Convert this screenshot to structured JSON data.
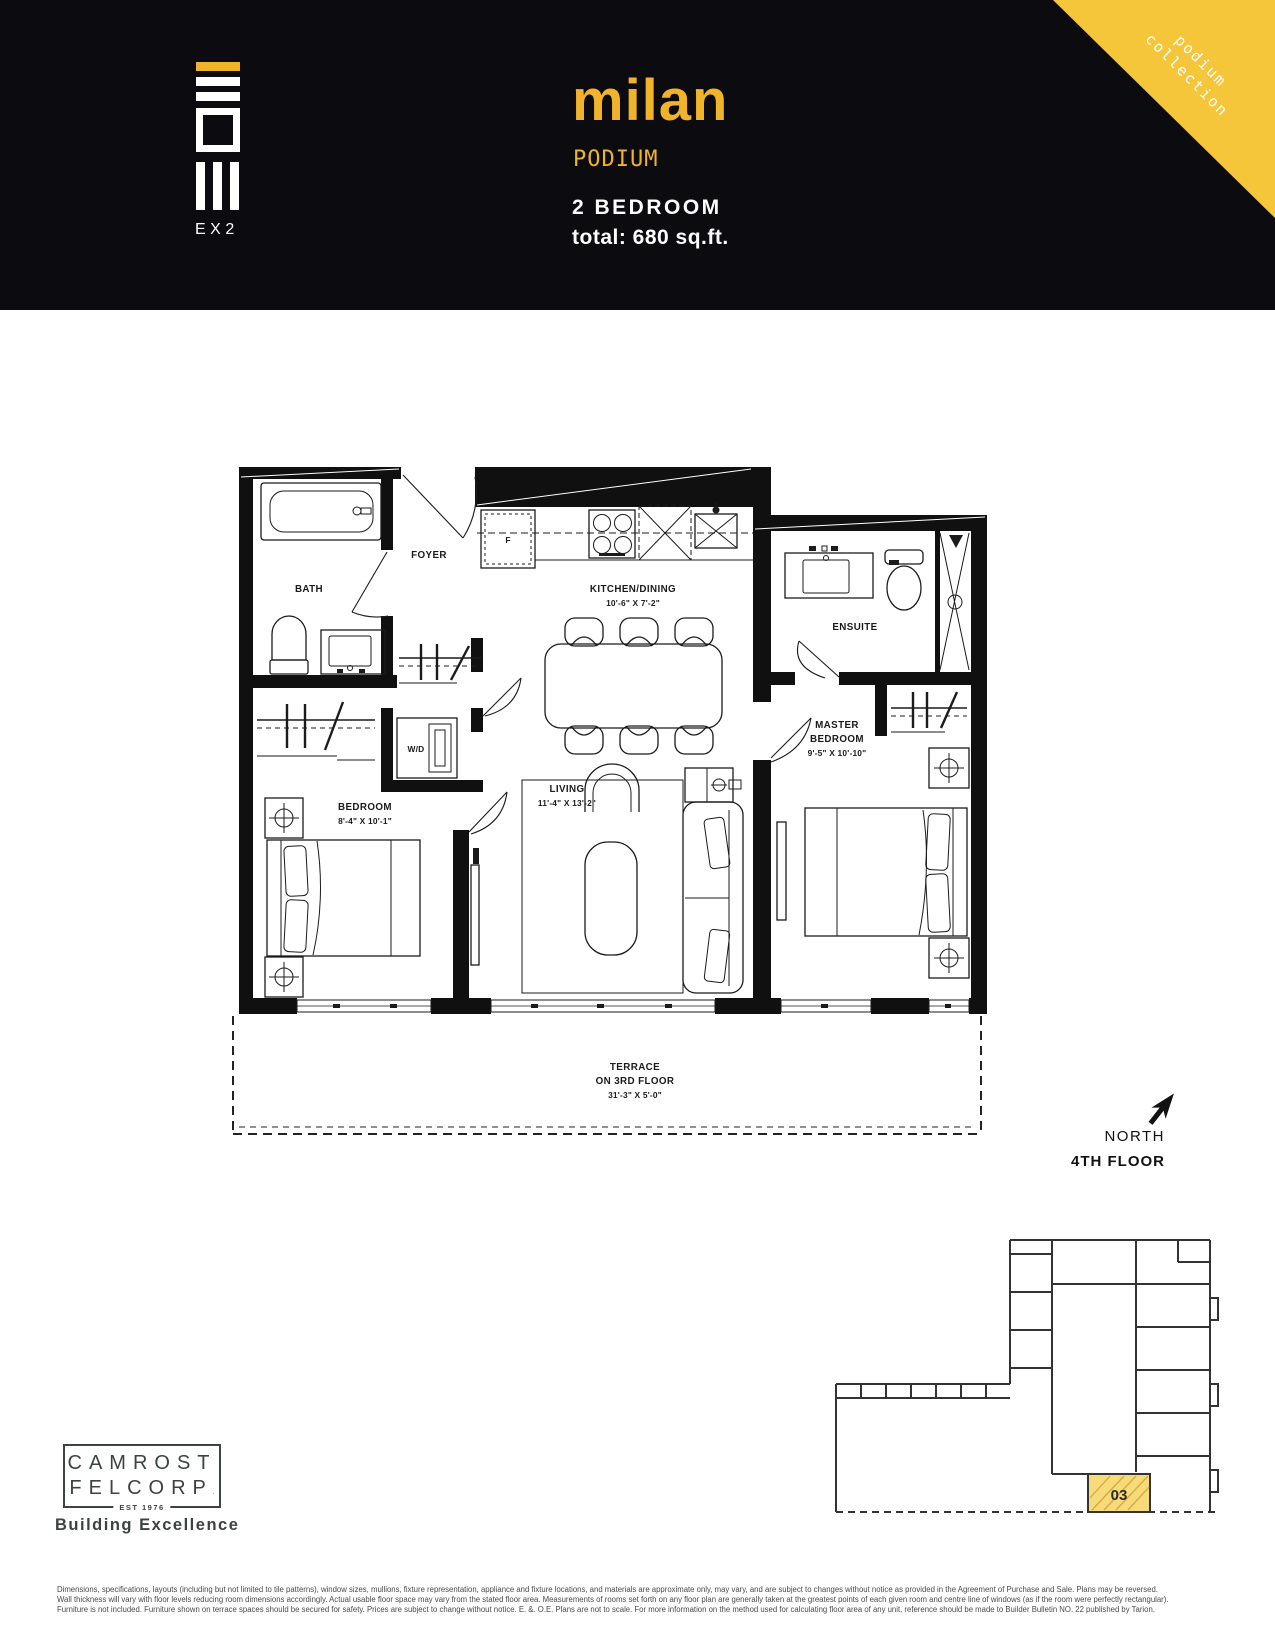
{
  "header": {
    "logo_mark": "EX2",
    "title": "milan",
    "subtitle": "PODIUM",
    "bedrooms": "2 BEDROOM",
    "area": "total: 680 sq.ft.",
    "ribbon": {
      "line1": "podium",
      "line2": "collection"
    }
  },
  "colors": {
    "header_bg": "#0B0B10",
    "accent_yellow": "#F0B32A",
    "ribbon_yellow": "#F5C53A",
    "keyplan_unit_fill": "#F7DB7A",
    "ink": "#101010",
    "logo_gray": "#3C4340"
  },
  "floor_plan": {
    "labels": {
      "bath": "BATH",
      "foyer": "FOYER",
      "kitchen": "KITCHEN/DINING",
      "kitchen_dims": "10'-6\" X 7'-2\"",
      "ensuite": "ENSUITE",
      "wd": "W/D",
      "fridge": "F",
      "bedroom": "BEDROOM",
      "bedroom_dims": "8'-4\" X 10'-1\"",
      "living": "LIVING",
      "living_dims": "11'-4\" X 13'-2\"",
      "master_line1": "MASTER",
      "master_line2": "BEDROOM",
      "master_dims": "9'-5\" X 10'-10\"",
      "terrace_line1": "TERRACE",
      "terrace_line2": "ON 3RD FLOOR",
      "terrace_dims": "31'-3\" X 5'-0\""
    }
  },
  "compass": {
    "north_label": "NORTH",
    "floor_label": "4TH FLOOR"
  },
  "keyplan": {
    "unit_number": "03"
  },
  "developer": {
    "name_line1": "CAMROST",
    "name_line2": "FELCORP",
    "trademark": ".",
    "established": "EST 1976",
    "tagline": "Building Excellence"
  },
  "footer": {
    "line1": "Dimensions, specifications, layouts (including but not limited to tile patterns), window sizes, mullions, fixture representation, appliance and fixture locations, and materials are approximate only, may vary, and are subject to changes without notice as provided in the Agreement of Purchase and Sale.  Plans may be reversed.",
    "line2": "Wall thickness will vary with floor levels reducing room dimensions accordingly. Actual usable floor space may vary from the stated floor area.  Measurements of rooms set forth on any floor plan are generally taken at the greatest points of each given room and centre line of windows (as if the room were perfectly rectangular).",
    "line3": "Furniture is not included.  Furniture shown on terrace spaces should be secured for safety.  Prices are subject to change without notice.  E. &. O.E. Plans are not to scale. For more information on the method used for calculating floor area of any unit, reference should be made to Builder Bulletin NO. 22 published by Tarion."
  }
}
